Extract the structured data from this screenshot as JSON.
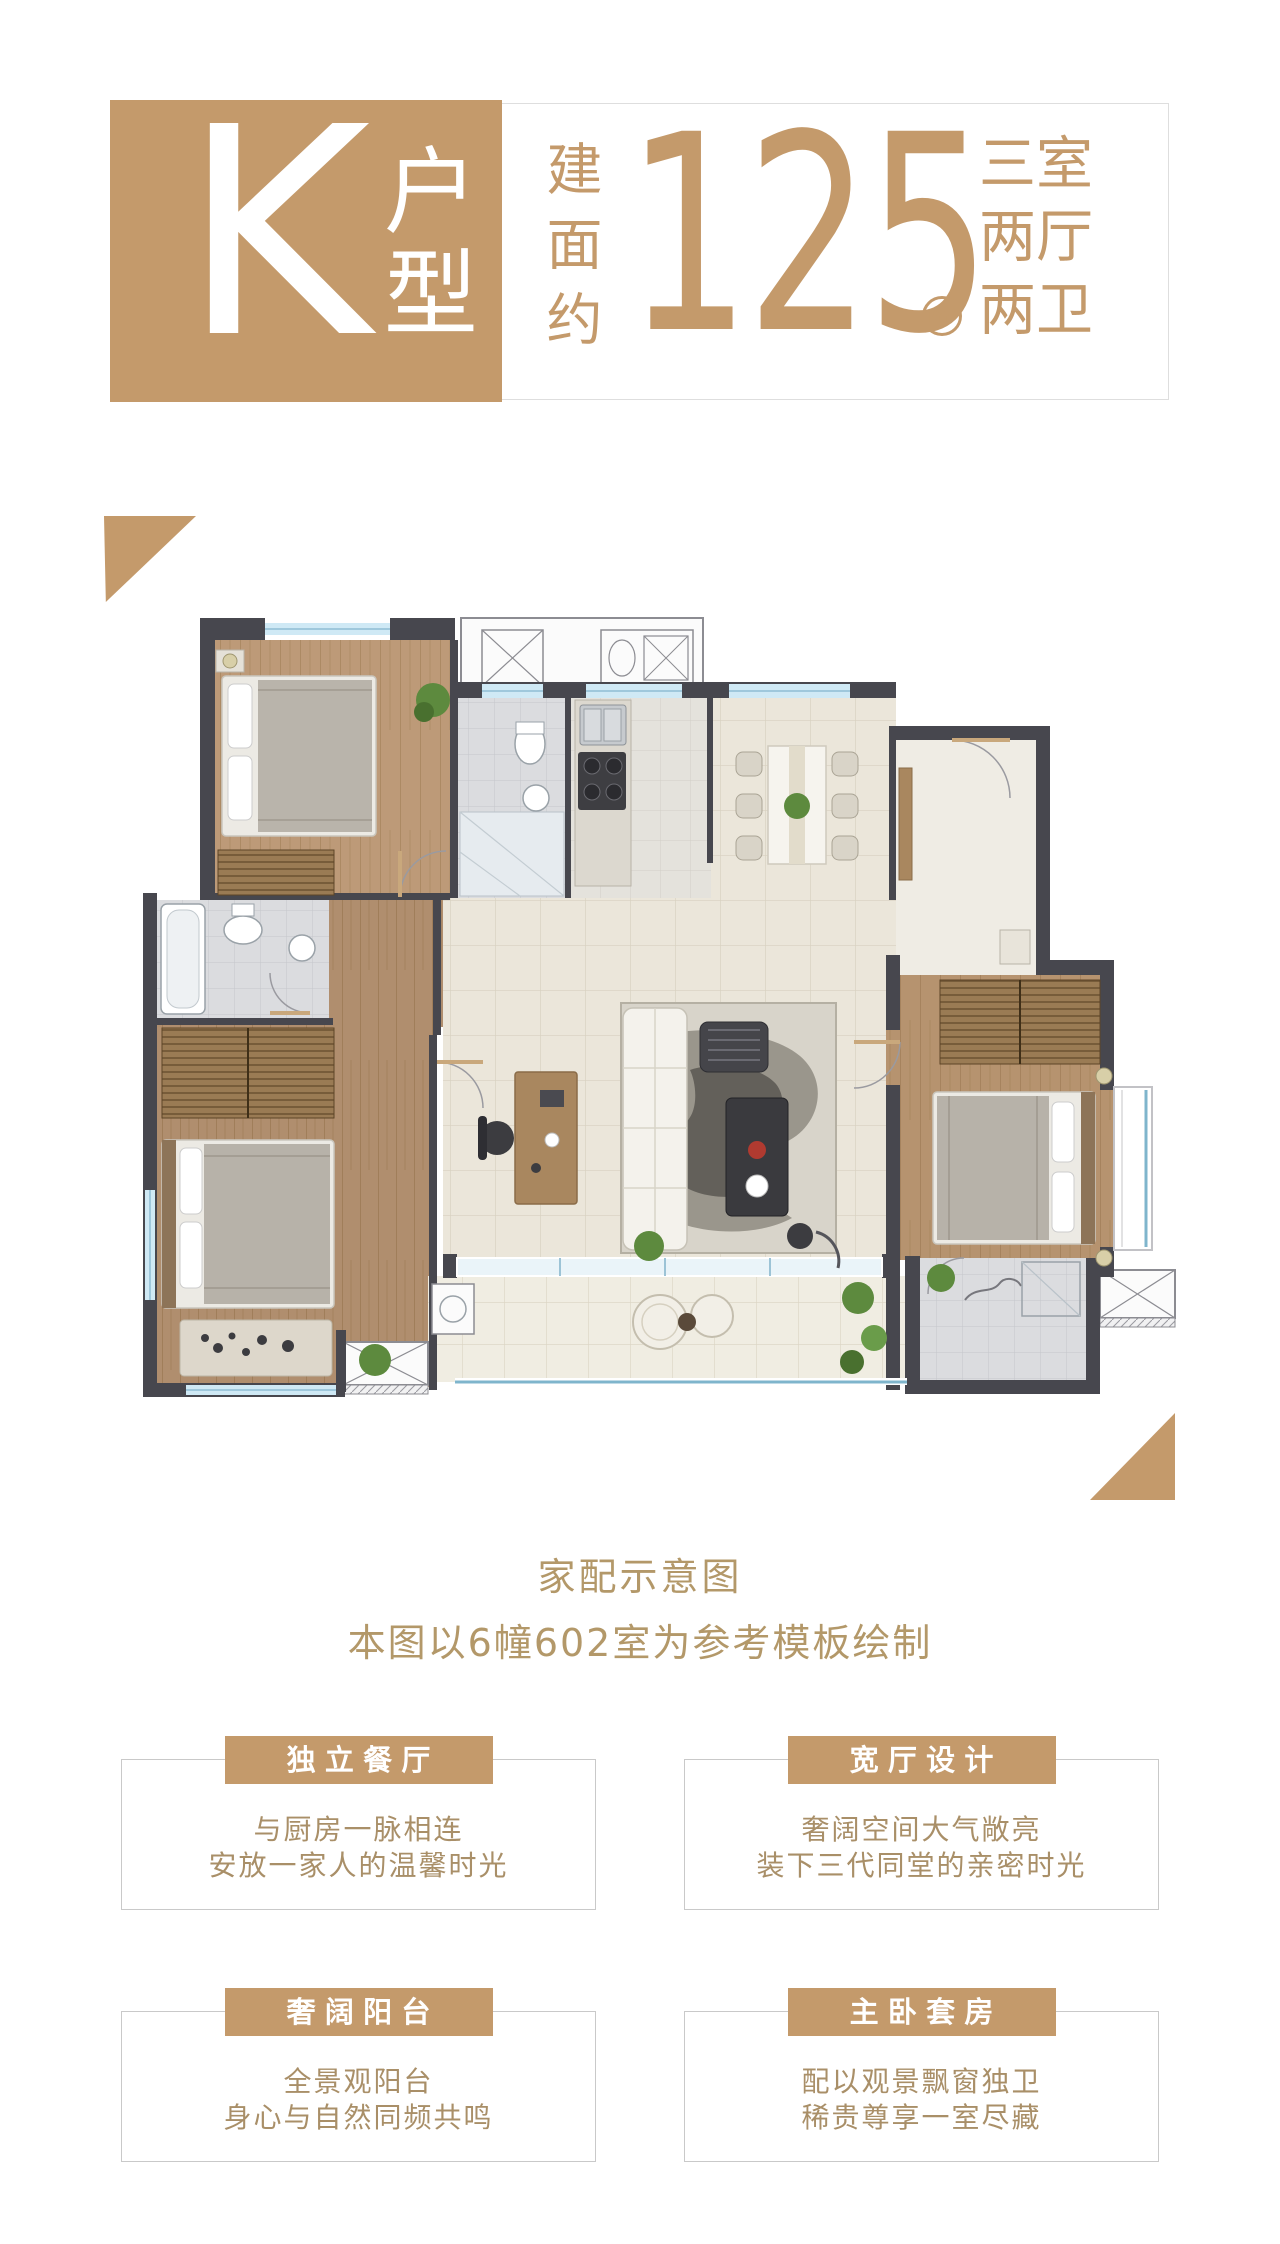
{
  "accent_color": "#c49a6b",
  "header": {
    "unit_letter": "K",
    "unit_label": "户型",
    "area_prefix": "建面约",
    "area_value": "125",
    "area_unit": "m²",
    "layout_lines": [
      "三室",
      "两厅",
      "两卫"
    ]
  },
  "floorplan": {
    "caption_title": "家配示意图",
    "caption_note": "本图以6幢602室为参考模板绘制"
  },
  "features": [
    {
      "title": "独立餐厅",
      "lines": [
        "与厨房一脉相连",
        "安放一家人的温馨时光"
      ]
    },
    {
      "title": "宽厅设计",
      "lines": [
        "奢阔空间大气敞亮",
        "装下三代同堂的亲密时光"
      ]
    },
    {
      "title": "奢阔阳台",
      "lines": [
        "全景观阳台",
        "身心与自然同频共鸣"
      ]
    },
    {
      "title": "主卧套房",
      "lines": [
        "配以观景飘窗独卫",
        "稀贵尊享一室尽藏"
      ]
    }
  ]
}
